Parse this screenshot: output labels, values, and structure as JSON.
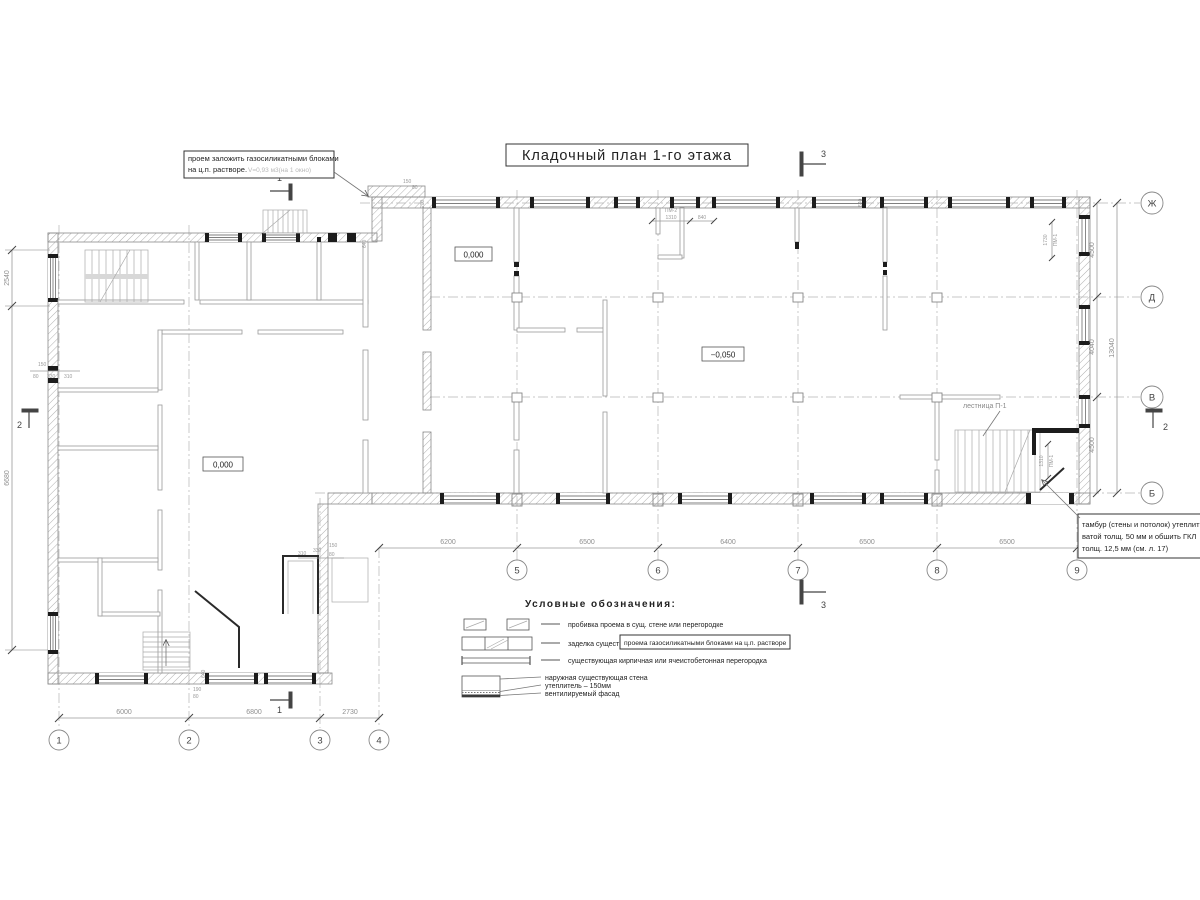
{
  "title": "Кладочный план 1-го этажа",
  "notes": {
    "opening_note": {
      "line1": "проем заложить газосиликатными блоками",
      "line2": "на ц.п. растворе.",
      "line2_volume": "V=0,93 м3(на 1 окно)"
    },
    "tambour_note": {
      "line1": "тамбур (стены и потолок) утеплить",
      "line2": "ватой толщ. 50 мм и обшить ГКЛ",
      "line3": "толщ. 12,5 мм (см. л. 17)"
    },
    "stair_label": "лестница П-1"
  },
  "elevations": {
    "ground_main": "0,000",
    "ground_left": "0,000",
    "lowered": "−0,050"
  },
  "grid_axes": {
    "bottom_left": [
      "1",
      "2",
      "3",
      "4"
    ],
    "bottom_mid": [
      "5",
      "6",
      "7",
      "8",
      "9"
    ],
    "right": [
      "Ж",
      "Д",
      "В",
      "Б"
    ]
  },
  "section_marks": {
    "s1": "1",
    "s2": "2",
    "s3": "3"
  },
  "dims": {
    "bottom_left": [
      "6000",
      "6800",
      "2730"
    ],
    "bottom_mid": [
      "6200",
      "6500",
      "6400",
      "6500",
      "6500"
    ],
    "right_side": [
      "4500",
      "4040",
      "4500"
    ],
    "right_total": "13040",
    "left_side": [
      "2540",
      "6680"
    ],
    "pm2": {
      "label": "ПМ-2",
      "width": "1310",
      "offset": "840"
    },
    "pm1_top": {
      "label": "ПМ-1",
      "width": "1730"
    },
    "pm1_stair": {
      "label": "ПМ-1",
      "width": "1310"
    },
    "small_left_wall": [
      "150",
      "80",
      "330",
      "310"
    ],
    "small_bottom": [
      "640",
      "190",
      "80"
    ],
    "small_top_junction": [
      "150",
      "80",
      "200",
      "640"
    ],
    "small_vestibule": [
      "310",
      "330",
      "150",
      "80"
    ],
    "small_top_wall": "640"
  },
  "legend": {
    "heading": "Условные обозначения:",
    "item1": "пробивка проема  в сущ. стене  или перегородке",
    "item2_pre": "заделка существ.",
    "item2_boxed": "проема газосиликатными блоками на ц.п. растворе",
    "item3": "существующая кирпичная или ячеистобетонная перегородка",
    "wall_detail": {
      "l1": "наружная существующая стена",
      "l2": "утеплитель – 150мм",
      "l3": "вентилируемый фасад"
    }
  }
}
